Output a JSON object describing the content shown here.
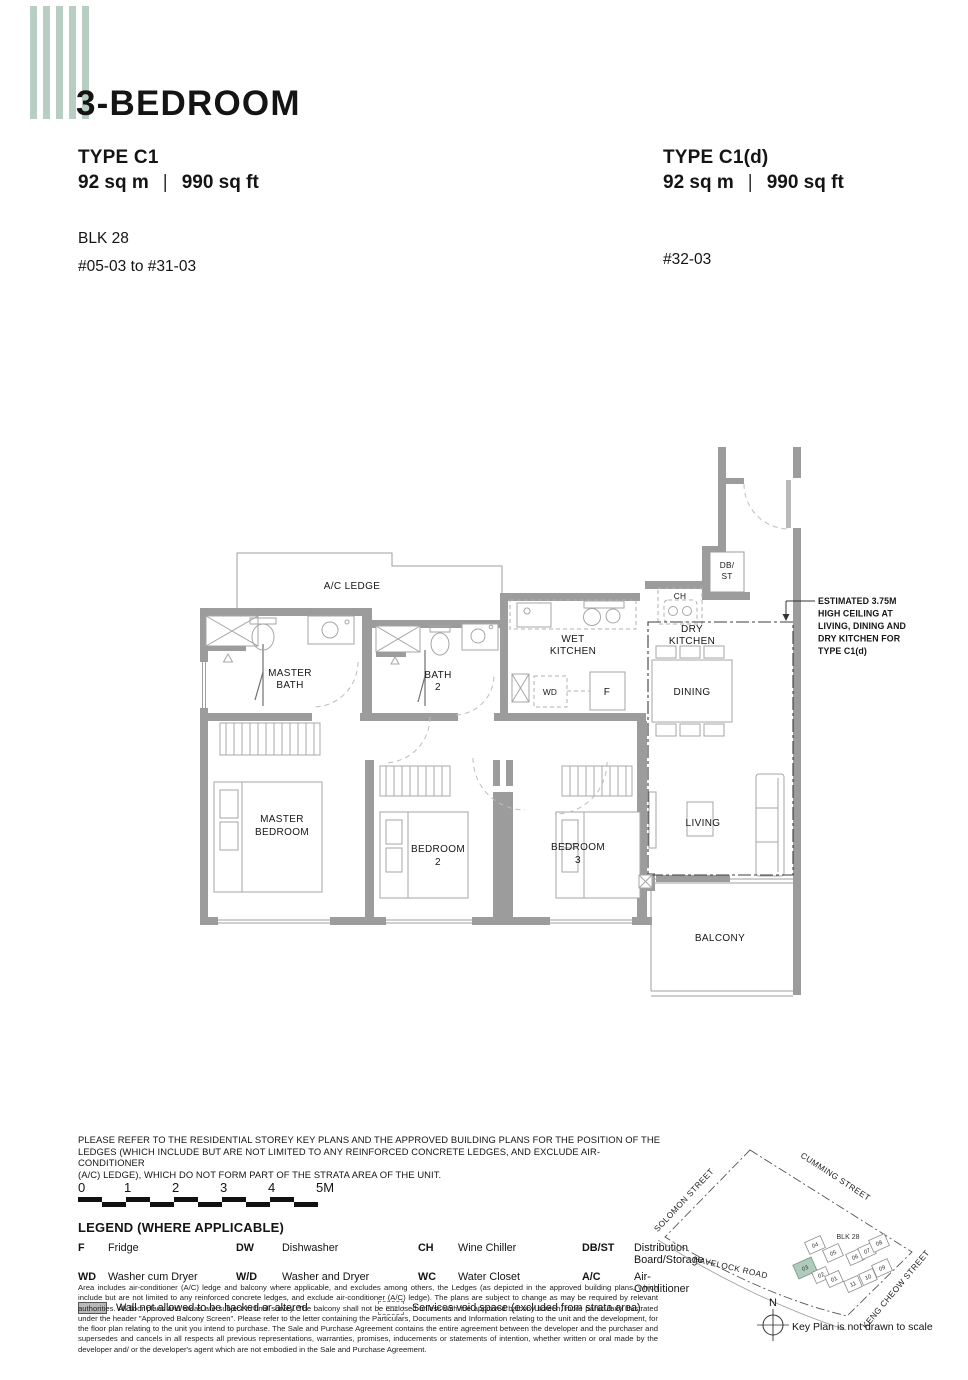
{
  "colors": {
    "stripe": "#b8cec3",
    "wall": "#9c9c9c",
    "highlight_unit": "#aecbbc"
  },
  "header": {
    "title": "3-BEDROOM",
    "left": {
      "type": "TYPE C1",
      "area_metric": "92 sq m",
      "area_imperial": "990 sq ft",
      "block": "BLK 28",
      "stack": "#05-03 to #31-03"
    },
    "right": {
      "type": "TYPE C1(d)",
      "area_metric": "92 sq m",
      "area_imperial": "990 sq ft",
      "stack": "#32-03"
    }
  },
  "plan": {
    "ac_ledge": "A/C LEDGE",
    "master_bath_1": "MASTER",
    "master_bath_2": "BATH",
    "bath2_1": "BATH",
    "bath2_2": "2",
    "wet_kitchen_1": "WET",
    "wet_kitchen_2": "KITCHEN",
    "dry_kitchen_1": "DRY",
    "dry_kitchen_2": "KITCHEN",
    "dining": "DINING",
    "db_st_1": "DB/",
    "db_st_2": "ST",
    "ch": "CH",
    "wd": "WD",
    "f": "F",
    "master_bedroom_1": "MASTER",
    "master_bedroom_2": "BEDROOM",
    "bedroom2_1": "BEDROOM",
    "bedroom2_2": "2",
    "bedroom3_1": "BEDROOM",
    "bedroom3_2": "3",
    "living": "LIVING",
    "balcony": "BALCONY",
    "annotation": {
      "l1": "ESTIMATED 3.75M",
      "l2": "HIGH CEILING AT",
      "l3": "LIVING, DINING AND",
      "l4": "DRY KITCHEN FOR",
      "l5": "TYPE C1(d)"
    }
  },
  "caption": {
    "l1": "PLEASE REFER TO THE RESIDENTIAL STOREY KEY PLANS AND THE APPROVED BUILDING PLANS FOR THE POSITION OF THE",
    "l2": "LEDGES (WHICH INCLUDE BUT ARE NOT LIMITED TO ANY REINFORCED CONCRETE LEDGES, AND EXCLUDE AIR-CONDITIONER",
    "l3": "(A/C) LEDGE), WHICH DO NOT FORM PART OF THE STRATA AREA OF THE UNIT."
  },
  "scale": {
    "ticks": [
      "0",
      "1",
      "2",
      "3",
      "4",
      "5M"
    ]
  },
  "legend": {
    "title": "LEGEND (WHERE APPLICABLE)",
    "items": [
      {
        "abbr": "F",
        "label": "Fridge"
      },
      {
        "abbr": "DW",
        "label": "Dishwasher"
      },
      {
        "abbr": "CH",
        "label": "Wine Chiller"
      },
      {
        "abbr": "DB/ST",
        "label": "Distribution Board/Storage"
      },
      {
        "abbr": "WD",
        "label": "Washer cum Dryer"
      },
      {
        "abbr": "W/D",
        "label": "Washer and Dryer"
      },
      {
        "abbr": "WC",
        "label": "Water Closet"
      },
      {
        "abbr": "A/C",
        "label": "Air-Conditioner"
      }
    ],
    "swatch_wall": "Wall not allowed to be hacked or altered",
    "swatch_void": "Services void space (excluded from strata area)"
  },
  "disclaimer": "Area includes air-conditioner (A/C) ledge and balcony where applicable, and excludes among others, the Ledges (as depicted in the approved building plans, which include but are not limited to any reinforced concrete ledges, and exclude air-conditioner (A/C) ledge). The plans are subject to change as may be required by relevant authorities. All floor plans and areas are subject to final survey. The balcony shall not be enclosed unless with the approved balcony screen, more particularly illustrated under the header \"Approved Balcony Screen\". Please refer to the letter containing the Particulars, Documents and Information relating to the unit and the development, for the floor plan relating to the unit you intend to purchase. The Sale and Purchase Agreement contains the entire agreement between the developer and the purchaser and supersedes and cancels in all respects all previous representations, warranties, promises, inducements or statements of intention, whether written or oral made by the developer and/ or the developer's agent which are not embodied in the Sale and Purchase Agreement.",
  "key_plan": {
    "blk": "BLK 28",
    "streets": {
      "solomon": "SOLOMON STREET",
      "cumming": "CUMMING STREET",
      "havelock": "HAVELOCK ROAD",
      "keng_cheow": "KENG CHEOW STREET"
    },
    "units": [
      "04",
      "05",
      "03",
      "02",
      "01",
      "06",
      "07",
      "08",
      "09",
      "10",
      "11"
    ],
    "highlighted_unit": "03",
    "north": "N",
    "note": "Key Plan is not drawn to scale"
  }
}
